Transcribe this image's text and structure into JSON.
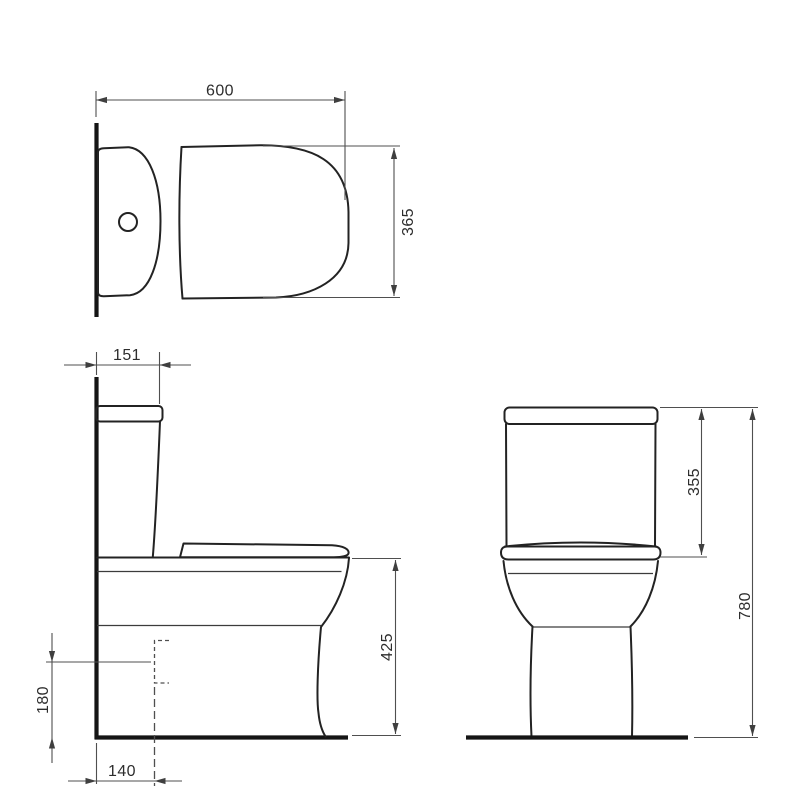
{
  "drawing": {
    "views": {
      "top": {
        "dimensions": {
          "width": "600",
          "seat_depth": "365"
        }
      },
      "side": {
        "dimensions": {
          "cistern_depth": "151",
          "rim_height": "425",
          "outlet_height": "180",
          "outlet_setout": "140"
        }
      },
      "front": {
        "dimensions": {
          "cistern_height": "355",
          "overall_height": "780"
        }
      }
    },
    "colors": {
      "background": "#ffffff",
      "outline": "#232323",
      "structure_line": "#151515",
      "dimension_line": "#4f4f4f",
      "label_text": "#2d2d2d"
    }
  }
}
